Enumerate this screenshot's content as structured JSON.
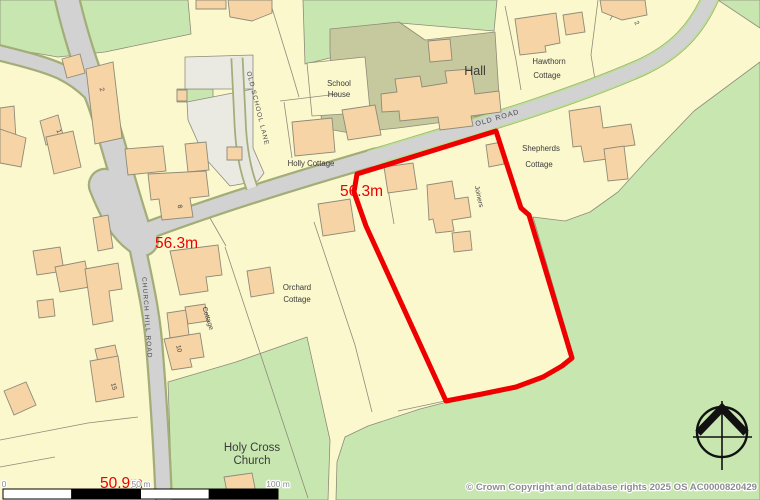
{
  "map": {
    "colors": {
      "cream": "#fbf8ce",
      "green": "#c8e7b0",
      "khaki": "#c6c89e",
      "yard": "#eae9e2",
      "road": "#d2d2d2",
      "lane": "#e7e6df",
      "casing": "#a3ad77",
      "verge": "#b9e195",
      "line": "#8e8b78",
      "building": "#f6d4a5",
      "buildingEdge": "#8e8b78",
      "site": "#ee0000",
      "spotHeight": "#ee0000",
      "text": "#3a3a3a",
      "roadText": "#4c4c4c",
      "grayText": "#8c8c8c",
      "compass": "#111111"
    },
    "areas": [
      {
        "id": "field-top-left",
        "fill": "green",
        "pts": "0,0 188,0 191,34 148,43 105,52 58,57 0,47"
      },
      {
        "id": "field-top-mid",
        "fill": "green",
        "pts": "303,0 497,0 494,31 400,23 368,46 334,57 305,64"
      },
      {
        "id": "green-sliver-yard",
        "fill": "green",
        "pts": "177,89 213,89 213,102 177,102"
      },
      {
        "id": "field-top-right-corner",
        "fill": "green",
        "pts": "718,0 760,0 760,28"
      },
      {
        "id": "field-east",
        "fill": "green",
        "pts": "760,62 694,111 648,159 618,192 590,212 565,221 533,217 574,358 561,367 541,377 515,388 482,395 447,402 420,409 368,426 345,437 337,462 336,500 760,500"
      },
      {
        "id": "field-church",
        "fill": "green",
        "pts": "168,382 236,362 307,337 330,440 328,500 172,500 170,440"
      },
      {
        "id": "hall-grounds",
        "fill": "khaki",
        "pts": "330,29 399,22 425,40 495,32 500,112 452,121 398,128 350,133 322,128 320,100 333,96 330,52"
      },
      {
        "id": "school-house-plot",
        "fill": "cream",
        "pts": "307,63 365,57 370,110 344,114 312,116"
      },
      {
        "id": "yard-upper",
        "fill": "yard",
        "pts": "185,57 253,55 253,89 185,89"
      },
      {
        "id": "yard-lower",
        "fill": "yard",
        "pts": "187,102 253,89 253,148 264,173 258,181 230,186 205,158 188,120"
      }
    ],
    "parcel_lines": [
      {
        "id": "pl-orchard-w",
        "d": "M225,247 L308,498"
      },
      {
        "id": "pl-orchard-e",
        "d": "M314,222 L355,345 L372,412"
      },
      {
        "id": "pl-holly-n",
        "d": "M272,8 L291,70 L299,97"
      },
      {
        "id": "pl-holly-w",
        "d": "M280,101 L338,94"
      },
      {
        "id": "pl-holly-s",
        "d": "M284,102 L292,158"
      },
      {
        "id": "pl-hawthorn-w",
        "d": "M505,6 L516,60 L521,90"
      },
      {
        "id": "pl-hawthorn-e",
        "d": "M598,0 L591,55 L597,92"
      },
      {
        "id": "pl-site-inner",
        "d": "M411,139 L384,166 L394,224"
      },
      {
        "id": "pl-bottom-left-1",
        "d": "M0,440 L88,423 L138,417"
      },
      {
        "id": "pl-bottom-left-2",
        "d": "M0,467 L55,457"
      },
      {
        "id": "pl-below-site",
        "d": "M445,401 L398,411"
      },
      {
        "id": "pl-junction-s",
        "d": "M210,218 L226,246"
      },
      {
        "id": "pl-topright-1",
        "d": "M622,0 L610,20"
      }
    ],
    "roads": [
      {
        "id": "road-northwest",
        "group": "main",
        "d": "M66,-6 C74,30 84,62 98,98 C110,130 122,180 140,235",
        "w": 22
      },
      {
        "id": "road-west-branch",
        "group": "main",
        "d": "M-4,52 C20,58 45,64 62,72 C72,77 82,84 90,92",
        "w": 13
      },
      {
        "id": "road-junction-flare",
        "group": "main",
        "d": "M105,185 C115,210 125,230 142,240",
        "w": 30
      },
      {
        "id": "old-road-west",
        "group": "main",
        "d": "M128,238 C200,210 280,185 376,157",
        "w": 15
      },
      {
        "id": "old-road-east",
        "group": "main",
        "d": "M372,158 C460,131 560,103 640,68 C675,52 697,30 712,-6",
        "w": 13.5,
        "verge": true
      },
      {
        "id": "church-hill-road",
        "group": "main",
        "d": "M136,240 C144,280 152,310 155,355 C159,405 162,455 164,504",
        "w": 14
      },
      {
        "id": "old-school-lane",
        "group": "lane",
        "d": "M237,58 L240,120 C241,150 246,172 252,188",
        "w": 9.5
      }
    ],
    "buildings": [
      {
        "id": "b-top-1",
        "pts": "196,0 226,0 226,9 196,9"
      },
      {
        "id": "b-top-2",
        "pts": "228,0 272,0 272,13 252,21 230,17"
      },
      {
        "id": "b-no2",
        "pts": "86,69 113,62 122,138 95,144"
      },
      {
        "id": "b-4",
        "pts": "62,59 80,54 85,73 67,78"
      },
      {
        "id": "b-5",
        "pts": "0,108 14,106 16,139 0,141"
      },
      {
        "id": "b-6",
        "pts": "40,121 58,115 64,139 46,145"
      },
      {
        "id": "b-7",
        "pts": "0,129 26,138 21,167 0,163"
      },
      {
        "id": "b-no1",
        "pts": "46,137 73,131 81,167 54,174"
      },
      {
        "id": "b-yard-sq",
        "pts": "177,90 187,90 187,101 177,101"
      },
      {
        "id": "b-yard",
        "pts": "185,144 206,142 209,170 188,172"
      },
      {
        "id": "b-11",
        "pts": "125,149 163,146 166,171 128,175"
      },
      {
        "id": "b-no8",
        "pts": "148,174 206,171 209,196 190,198 193,217 162,220 159,199 151,200"
      },
      {
        "id": "b-13",
        "pts": "227,147 242,147 242,160 227,160"
      },
      {
        "id": "b-holly-cottage",
        "pts": "292,122 332,118 335,152 295,156"
      },
      {
        "id": "b-school-house",
        "pts": "342,110 375,105 381,135 348,140"
      },
      {
        "id": "b-hall-north",
        "pts": "428,41 450,39 452,60 430,62"
      },
      {
        "id": "b-hall",
        "pts": "381,94 397,92 395,79 420,76 422,87 447,83 445,71 471,69 475,94 499,91 501,112 471,116 473,126 440,130 438,117 400,121 399,111 382,112"
      },
      {
        "id": "b-hawthorn",
        "pts": "515,19 556,13 560,43 545,46 546,52 520,55"
      },
      {
        "id": "b-hawthorn-annex",
        "pts": "563,15 582,12 585,32 566,35"
      },
      {
        "id": "b-topright",
        "pts": "600,0 645,0 647,15 622,20 602,12"
      },
      {
        "id": "b-shepherds",
        "pts": "569,111 600,106 603,128 631,124 635,145 606,149 608,159 584,162 581,146 573,147"
      },
      {
        "id": "b-shepherds-annex",
        "pts": "604,149 624,146 628,179 608,181"
      },
      {
        "id": "b-23",
        "pts": "486,145 501,142 504,164 489,167"
      },
      {
        "id": "b-joiners-a",
        "pts": "384,167 413,163 417,189 388,193"
      },
      {
        "id": "b-joiners-main",
        "pts": "427,185 452,181 455,199 468,197 471,217 452,220 454,231 436,233 433,219 429,220"
      },
      {
        "id": "b-joiners-small",
        "pts": "452,233 470,231 472,250 454,252"
      },
      {
        "id": "b-west-of-site",
        "pts": "318,204 350,199 355,231 323,236"
      },
      {
        "id": "b-27",
        "pts": "33,251 60,247 64,271 37,275"
      },
      {
        "id": "b-28",
        "pts": "55,267 85,261 90,287 60,292"
      },
      {
        "id": "b-29",
        "pts": "85,269 118,263 122,289 109,291 113,321 93,325"
      },
      {
        "id": "b-30",
        "pts": "37,301 53,299 55,316 39,318"
      },
      {
        "id": "b-42",
        "pts": "93,218 108,215 113,248 98,251"
      },
      {
        "id": "b-31",
        "pts": "95,349 115,345 119,362 99,366"
      },
      {
        "id": "b-no15",
        "pts": "90,361 118,356 124,397 96,402"
      },
      {
        "id": "b-left-diamond",
        "pts": "4,391 26,382 36,405 14,415"
      },
      {
        "id": "b-cottage",
        "pts": "167,313 186,310 189,335 170,338"
      },
      {
        "id": "b-cottage-annex",
        "pts": "185,307 205,304 208,321 188,324"
      },
      {
        "id": "b-no10",
        "pts": "164,339 200,333 204,357 190,359 192,367 172,370"
      },
      {
        "id": "b-orchard-n1",
        "pts": "170,251 218,245 222,275 206,277 208,291 180,295"
      },
      {
        "id": "b-orchard-n2",
        "pts": "247,271 270,267 274,293 251,297"
      },
      {
        "id": "b-church",
        "pts": "224,477 252,473 256,493 228,497"
      }
    ],
    "site_boundary": {
      "pts": "357,174 496,131 521,208 529,215 572,358 562,366 543,377 516,387 482,394 446,401 366,226 354,192",
      "width": 5
    },
    "scale_bar": {
      "x": 3,
      "y": 489,
      "h": 10,
      "seg_w": 68.75,
      "segments": [
        "#ffffff",
        "#000000",
        "#ffffff",
        "#000000"
      ]
    },
    "compass": {
      "cx": 722,
      "cy": 432,
      "r": 25
    },
    "labels": [
      {
        "id": "label-hall",
        "text": "Hall",
        "x": 475,
        "y": 75,
        "size": 12.5,
        "color": "text"
      },
      {
        "id": "label-school-house-1",
        "text": "School",
        "x": 339,
        "y": 86,
        "size": 7.8,
        "color": "text"
      },
      {
        "id": "label-school-house-2",
        "text": "House",
        "x": 339,
        "y": 97,
        "size": 7.8,
        "color": "text"
      },
      {
        "id": "label-hawthorn-1",
        "text": "Hawthorn",
        "x": 549,
        "y": 64,
        "size": 7.8,
        "color": "text"
      },
      {
        "id": "label-hawthorn-2",
        "text": "Cottage",
        "x": 547,
        "y": 78,
        "size": 7.8,
        "color": "text"
      },
      {
        "id": "label-holly-cottage",
        "text": "Holly Cottage",
        "x": 311,
        "y": 166,
        "size": 7.8,
        "color": "text"
      },
      {
        "id": "label-shepherds-1",
        "text": "Shepherds",
        "x": 541,
        "y": 151,
        "size": 7.8,
        "color": "text"
      },
      {
        "id": "label-shepherds-2",
        "text": "Cottage",
        "x": 539,
        "y": 167,
        "size": 7.8,
        "color": "text"
      },
      {
        "id": "label-joiners",
        "text": "Joiners",
        "x": 477,
        "y": 197,
        "size": 6.8,
        "rot": 78,
        "color": "text"
      },
      {
        "id": "label-orchard-1",
        "text": "Orchard",
        "x": 297,
        "y": 290,
        "size": 7.8,
        "color": "text"
      },
      {
        "id": "label-orchard-2",
        "text": "Cottage",
        "x": 297,
        "y": 302,
        "size": 7.8,
        "color": "text"
      },
      {
        "id": "label-cottage-rot",
        "text": "Cottage",
        "x": 206,
        "y": 319,
        "size": 6.8,
        "rot": 72,
        "color": "text"
      },
      {
        "id": "label-holy-cross-1",
        "text": "Holy Cross",
        "x": 252,
        "y": 451,
        "size": 11.5,
        "color": "text"
      },
      {
        "id": "label-holy-cross-2",
        "text": "Church",
        "x": 252,
        "y": 464,
        "size": 11.5,
        "color": "text"
      },
      {
        "id": "label-church-hill-road",
        "text": "CHURCH HILL ROAD",
        "x": 145,
        "y": 318,
        "size": 6.5,
        "rot": 86,
        "ls": 1.1,
        "color": "roadText"
      },
      {
        "id": "label-old-school-lane",
        "text": "OLD SCHOOL LANE",
        "x": 256,
        "y": 109,
        "size": 6.5,
        "rot": 76,
        "ls": 1,
        "color": "roadText"
      },
      {
        "id": "label-old-road",
        "text": "OLD ROAD",
        "x": 498,
        "y": 120,
        "size": 7.2,
        "rot": -16,
        "ls": 1,
        "color": "roadText"
      },
      {
        "id": "label-no-2",
        "text": "2",
        "x": 100,
        "y": 90,
        "size": 6.5,
        "rot": 75,
        "color": "text"
      },
      {
        "id": "label-no-1",
        "text": "1",
        "x": 57,
        "y": 132,
        "size": 6.5,
        "rot": 70,
        "color": "text"
      },
      {
        "id": "label-no-8",
        "text": "8",
        "x": 178,
        "y": 207,
        "size": 6.5,
        "rot": 75,
        "color": "text"
      },
      {
        "id": "label-no-10",
        "text": "10",
        "x": 177,
        "y": 349,
        "size": 6.5,
        "rot": 78,
        "color": "text"
      },
      {
        "id": "label-no-15",
        "text": "15",
        "x": 112,
        "y": 387,
        "size": 6.5,
        "rot": 75,
        "color": "text"
      },
      {
        "id": "label-no-2b",
        "text": "2",
        "x": 635,
        "y": 24,
        "size": 6.5,
        "rot": 60,
        "color": "text"
      },
      {
        "id": "spot-height-1",
        "text": "56.3m",
        "x": 340,
        "y": 196,
        "size": 15.5,
        "color": "spotHeight",
        "anchor": "start"
      },
      {
        "id": "spot-height-2",
        "text": "56.3m",
        "x": 155,
        "y": 248,
        "size": 15.5,
        "color": "spotHeight",
        "anchor": "start"
      },
      {
        "id": "spot-height-3",
        "text": "50.9m",
        "x": 100,
        "y": 488,
        "size": 15.5,
        "color": "spotHeight",
        "anchor": "start"
      },
      {
        "id": "scale-label-0",
        "text": "0",
        "x": 4,
        "y": 487,
        "size": 8.5,
        "color": "grayText",
        "halo": true
      },
      {
        "id": "scale-label-50",
        "text": "50 m",
        "x": 141,
        "y": 487,
        "size": 8.5,
        "color": "grayText",
        "halo": true
      },
      {
        "id": "scale-label-100",
        "text": "100 m",
        "x": 278,
        "y": 487,
        "size": 8.5,
        "color": "grayText",
        "halo": true
      },
      {
        "id": "copyright",
        "text": "© Crown Copyright and database rights 2025 OS AC0000820429",
        "x": 757,
        "y": 490,
        "size": 9.6,
        "color": "grayText",
        "anchor": "end",
        "halo": true,
        "bold": true
      }
    ]
  }
}
